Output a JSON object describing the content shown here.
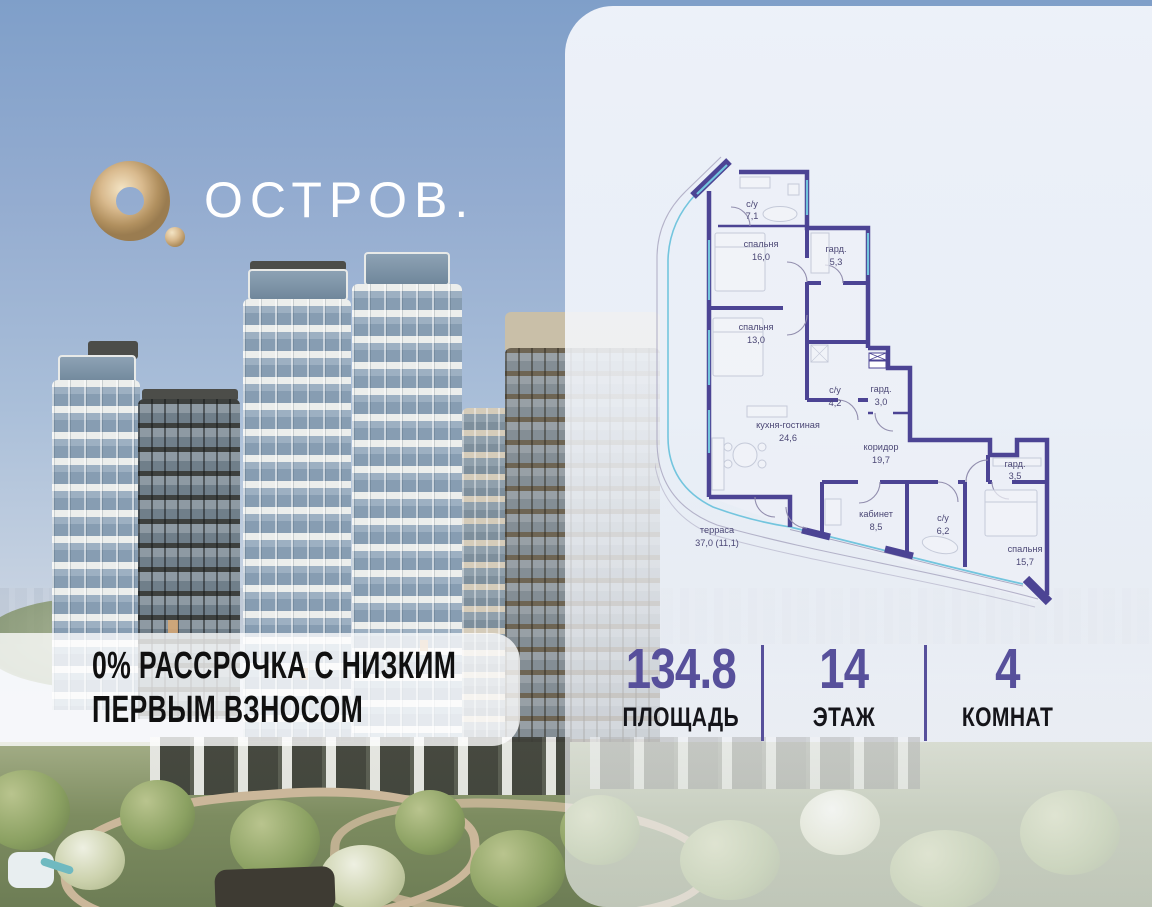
{
  "brand": {
    "name": "ОСТРОВ."
  },
  "promo": {
    "line1": "0% РАССРОЧКА С НИЗКИМ",
    "line2": "ПЕРВЫМ ВЗНОСОМ"
  },
  "plan": {
    "rooms": [
      {
        "name": "с/у",
        "area": "7,1"
      },
      {
        "name": "спальня",
        "area": "16,0"
      },
      {
        "name": "гард.",
        "area": "5,3"
      },
      {
        "name": "спальня",
        "area": "13,0"
      },
      {
        "name": "с/у",
        "area": "4,2"
      },
      {
        "name": "гард.",
        "area": "3,0"
      },
      {
        "name": "кухня-гостиная",
        "area": "24,6"
      },
      {
        "name": "коридор",
        "area": "19,7"
      },
      {
        "name": "гард.",
        "area": "3,5"
      },
      {
        "name": "кабинет",
        "area": "8,5"
      },
      {
        "name": "с/у",
        "area": "6,2"
      },
      {
        "name": "спальня",
        "area": "15,7"
      },
      {
        "name": "терраса",
        "area": "37,0 (11,1)"
      }
    ]
  },
  "stats": [
    {
      "value": "134.8",
      "label": "ПЛОЩАДЬ"
    },
    {
      "value": "14",
      "label": "ЭТАЖ"
    },
    {
      "value": "4",
      "label": "КОМНАТ"
    }
  ],
  "colors": {
    "accent": "#57509b",
    "wall": "#4c4494",
    "glazing": "#73c5de",
    "gold": "#c9a87c"
  }
}
